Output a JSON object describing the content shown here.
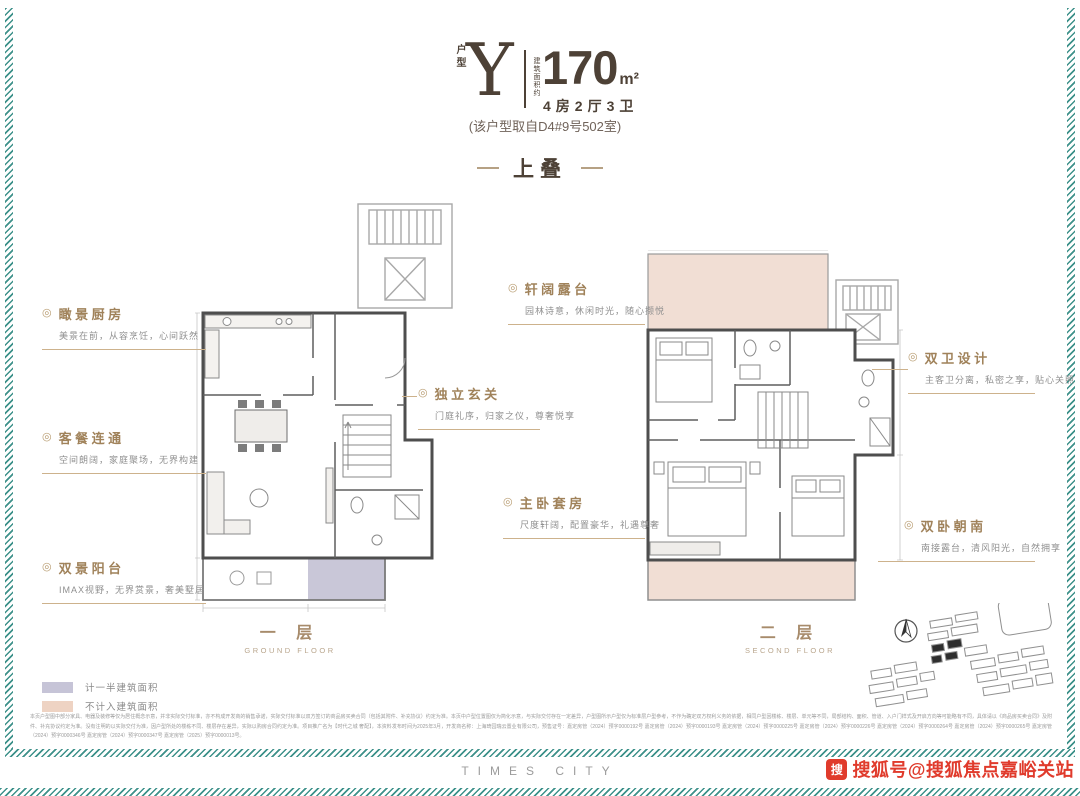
{
  "header": {
    "unit_label": "户型",
    "unit_type": "Y",
    "area_label": "建筑面积约",
    "area_value": "170",
    "area_unit": "m²",
    "rooms": "4房2厅3卫",
    "source_note": "(该户型取自D4#9号502室)"
  },
  "section_title": "上叠",
  "bullet": "◎",
  "callouts": {
    "left": [
      {
        "title": "瞰景厨房",
        "desc": "美景在前，从容烹饪，心间跃然"
      },
      {
        "title": "客餐连通",
        "desc": "空间朗阔，家庭聚场，无界构建"
      },
      {
        "title": "双景阳台",
        "desc": "IMAX视野，无界赏景，奢美墅居"
      }
    ],
    "middle": [
      {
        "title": "轩阔露台",
        "desc": "园林诗意，休闲时光，随心撷悦"
      },
      {
        "title": "独立玄关",
        "desc": "门庭礼序，归家之仪，尊奢悦享"
      },
      {
        "title": "主卧套房",
        "desc": "尺度轩阔，配置豪华，礼遇尊奢"
      }
    ],
    "right": [
      {
        "title": "双卫设计",
        "desc": "主客卫分离，私密之享，贴心关照"
      },
      {
        "title": "双卧朝南",
        "desc": "南接露台，清风阳光，自然拥享"
      }
    ]
  },
  "floors": [
    {
      "zh": "一 层",
      "en": "GROUND FLOOR"
    },
    {
      "zh": "二 层",
      "en": "SECOND FLOOR"
    }
  ],
  "legend": [
    {
      "label": "计一半建筑面积",
      "color": "#c6c4d7"
    },
    {
      "label": "不计入建筑面积",
      "color": "#eed3c3"
    }
  ],
  "disclaimer": "本页户型图中部分家具、电器及装修等仅为居住概念示意，并非实际交付标准，亦不构成开发商的销售承诺，实际交付标准以双方签订的商品房买卖合同（包括其附件、补充协议）约定为准。本页中户型位置图仅为简化示意，与实际交付存在一定差异，户型图所示户型仅为标准层户型参考，不作为确定双方权利义务的依据，相同户型因楼栋、楼层、单元等不同，局部结构、面积、管道、入户门样式及开启方向等可能略有不同，具体请以《商品房买卖合同》及附件、补充协议约定为准。没有注明的以实际交付为准，因户型所处的楼栋不同、楼层存在差异，实际以购房合同约定为准。项目推广名为【时代之城 奢配】，本资料发布时间为2025年3月，开发商名称：上海琦园瑞云置业有限公司，预售证号：嘉定房管（2024）预字0000192号 嘉定房管（2024）预字0000193号 嘉定房管（2024）预字0000225号 嘉定房管（2024）预字0000226号 嘉定房管（2024）预字0000264号 嘉定房管（2024）预字0000265号 嘉定房管（2024）预字0000346号 嘉定房管（2024）预字0000347号 嘉定房管（2025）预字0000013号。",
  "footer": {
    "brand": "TIMES CITY",
    "watermark": "搜狐号@搜狐焦点嘉峪关站",
    "watermark_icon_char": "搜"
  },
  "colors": {
    "accent_gold": "#a0825a",
    "dark_brown": "#4d4136",
    "stripe_teal": "#3d918a",
    "watermark_red": "#e03b2c"
  }
}
